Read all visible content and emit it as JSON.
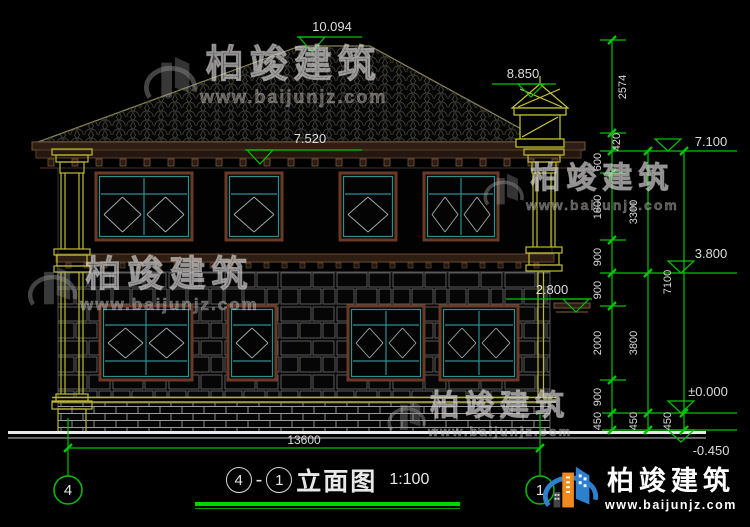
{
  "watermark": {
    "brand": "柏竣建筑",
    "site": "www.baijunjz.com"
  },
  "logo": {
    "brand": "柏竣建筑",
    "site": "www.baijunjz.com"
  },
  "title_block": {
    "axis_start": "4",
    "separator": "-",
    "axis_end": "1",
    "name": "立面图",
    "scale": "1:100"
  },
  "grid_bubbles": {
    "left": "4",
    "right": "1"
  },
  "levels": {
    "ridge": "10.094",
    "chimney": "8.850",
    "eave": "7.520",
    "plate": "7.100",
    "floor2": "3.800",
    "canopy": "2.800",
    "zero": "±0.000",
    "site": "-0.450"
  },
  "dims": {
    "a1": "2574",
    "a2": "420",
    "a3": "600",
    "a4": "1800",
    "a5": "900",
    "a6": "900",
    "a7": "2000",
    "a8": "900",
    "a9": "450",
    "b1": "3300",
    "b2": "3800",
    "b3": "450",
    "c1": "7100",
    "c2": "450",
    "total": "13600"
  }
}
